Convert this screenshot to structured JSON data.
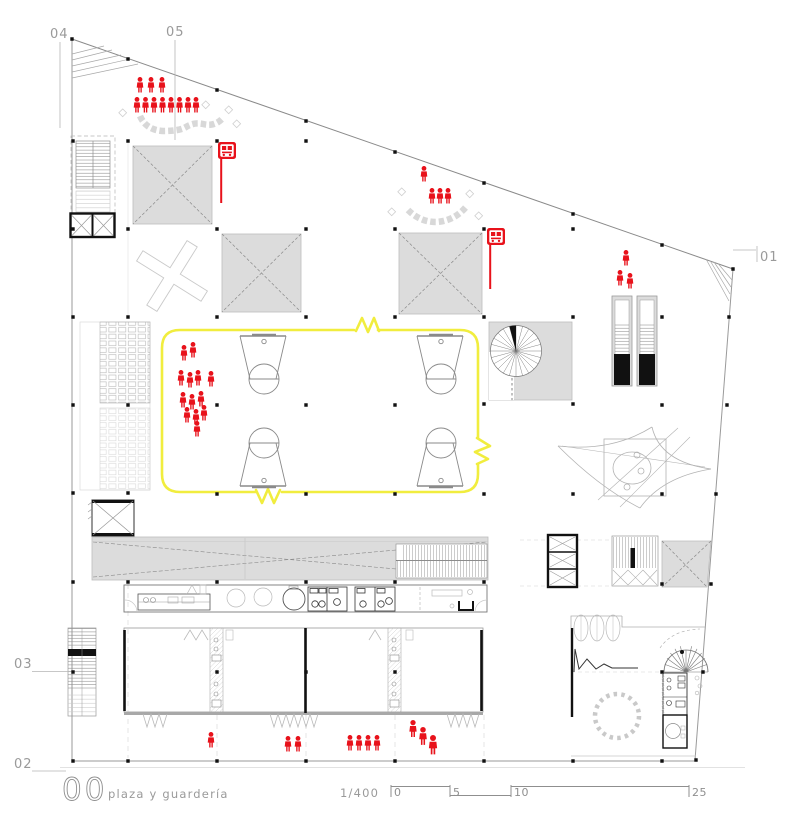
{
  "drawing": {
    "level_number": "00",
    "level_title": "plaza y guardería",
    "scale_ratio": "1/400",
    "scale_bar_ticks": [
      "0",
      "5",
      "10",
      "25"
    ],
    "grid_markers": {
      "m04": "04",
      "m05": "05",
      "m01": "01",
      "m03": "03",
      "m02": "02"
    }
  },
  "colors": {
    "accent_red": "#e8121b",
    "court_yellow": "#f1ed3e",
    "canopy_gray": "#dcdcdc",
    "line_gray": "#8f8f8f"
  },
  "icons": {
    "bus_stop": "bus-stop-sign",
    "person": "person-silhouette",
    "spiral_stair": "spiral-stair",
    "elevator": "elevator-x-box"
  }
}
